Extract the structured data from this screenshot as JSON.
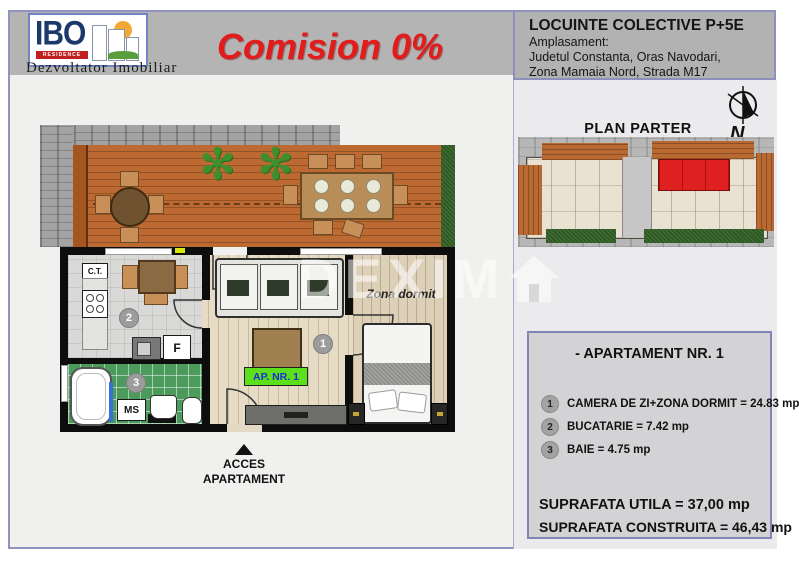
{
  "logo": {
    "name": "IBO",
    "residence": "RESIDENCE",
    "subtitle": "Dezvoltator  Imobiliar"
  },
  "header": {
    "promo": "Comision 0%",
    "project_title": "LOCUINTE COLECTIVE P+5E",
    "location_label": "Amplasament:",
    "location_line1": "Judetul Constanta, Oras Navodari,",
    "location_line2": "Zona Mamaia Nord,  Strada M17"
  },
  "site_plan": {
    "title": "PLAN PARTER",
    "compass_label": "N"
  },
  "floor_plan": {
    "apartment_label": "AP. NR. 1",
    "sleep_zone_label": "Zona dormit",
    "boiler_label": "C.T.",
    "fridge_label": "F",
    "washer_label": "MS",
    "room1_number": "1",
    "room2_number": "2",
    "room3_number": "3",
    "access_line1": "ACCES",
    "access_line2": "APARTAMENT"
  },
  "watermark": {
    "text": "DEXIM"
  },
  "apartment_info": {
    "title": "- APARTAMENT NR. 1",
    "rooms": [
      {
        "number": "1",
        "label": "CAMERA DE ZI+ZONA DORMIT = 24.83 mp"
      },
      {
        "number": "2",
        "label": "BUCATARIE = 7.42 mp"
      },
      {
        "number": "3",
        "label": "BAIE = 4.75 mp"
      }
    ],
    "suprafata_utila": "SUPRAFATA UTILA = 37,00 mp",
    "suprafata_construita": "SUPRAFATA CONSTRUITA = 46,43 mp"
  },
  "colors": {
    "accent_red": "#e21b1b",
    "highlight_red": "#df2020",
    "label_green": "#5ce01e",
    "label_blue": "#1c2bd4",
    "frame_purple": "#9093bf",
    "header_gray": "#b4b4b4"
  }
}
